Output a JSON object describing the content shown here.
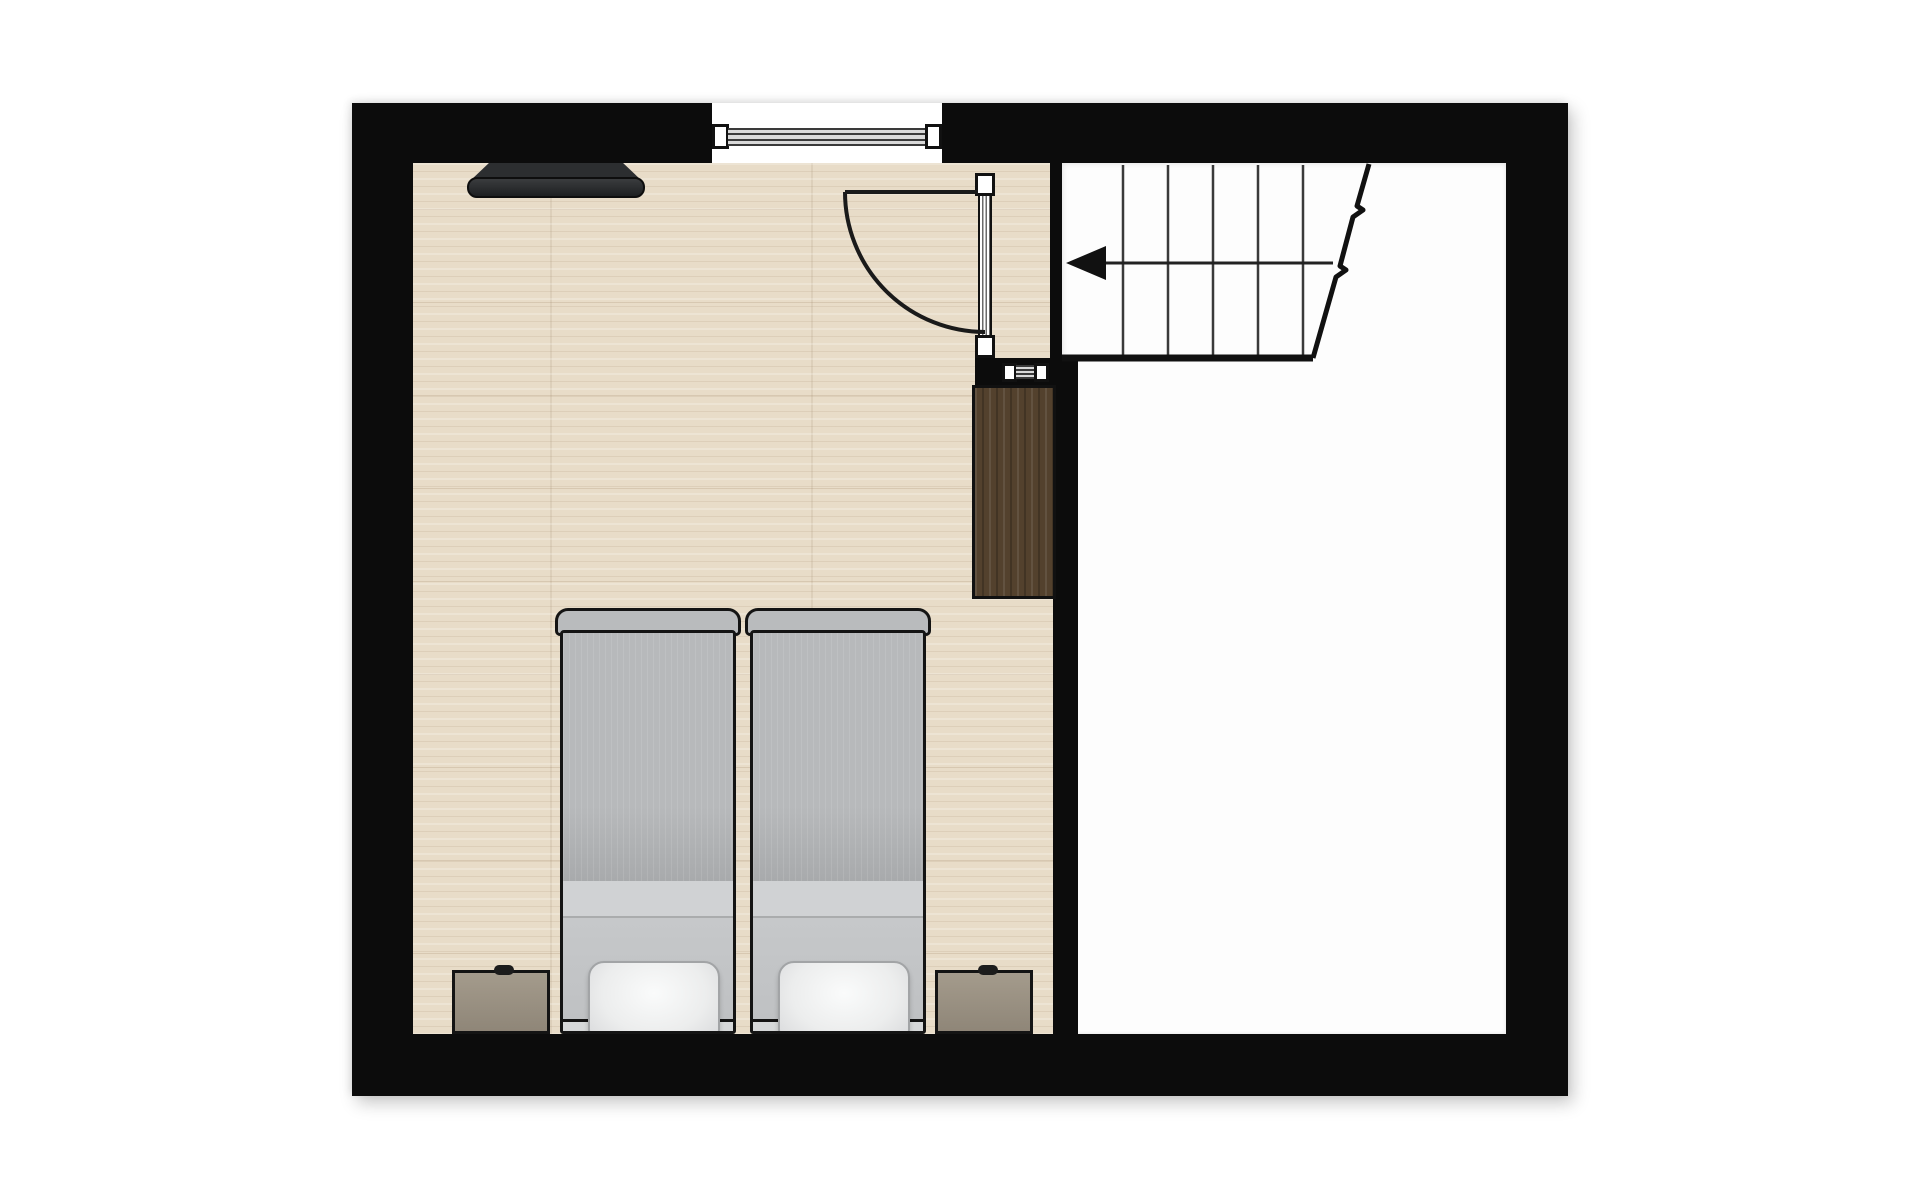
{
  "scene": {
    "type": "floor-plan",
    "description": "Upper-floor bedroom plan with two twin beds, two nightstands, wardrobe, wall TV, window, swing door and staircase landing next to an empty stair-hall room"
  },
  "palette": {
    "wall": "#0c0c0c",
    "wood_floor": "#e8dcc8",
    "wood_grain": "#927555",
    "white_room": "#fdfdfd",
    "wardrobe_wood": "#53412d",
    "nightstand": "#9a9183",
    "bed_outline": "#141414",
    "duvet": "#b3b6b8",
    "fold_band": "#d0d2d4",
    "sheet": "#c3c5c7",
    "pillow": "#f2f3f4",
    "headboard": "#d6d8d9",
    "tv": "#2c2e30",
    "glazing_dark": "#3a3a3a",
    "glazing_light": "#d9d9d9"
  },
  "rooms": [
    {
      "name": "bedroom",
      "floor": "wood"
    },
    {
      "name": "stair-hall",
      "floor": "white"
    }
  ],
  "window": {
    "glazing_lines": 4,
    "position": "top-wall"
  },
  "mini_window": {
    "glazing_lines": 3,
    "position": "interior-stub-wall"
  },
  "door": {
    "hinge": "top",
    "swing": "into-bedroom",
    "arc": {
      "open_line": {
        "x1": 493,
        "y1": 89,
        "x2": 626,
        "y2": 89
      },
      "arc_path": "M493,89 A140,140 0 0 0 633,229"
    }
  },
  "stairs": {
    "tread_count": 5,
    "tread_xs": [
      771,
      816,
      861,
      906,
      951
    ],
    "tread_top_y": 62,
    "tread_bottom_y": 255,
    "bottom_line": {
      "x1": 710,
      "y1": 255,
      "x2": 961,
      "y2": 255
    },
    "break_line_path": "M1017,61 L1005,103 l6,4 l-10,7 L988,163 l6,4 l-10,7 L961,255",
    "arrow": {
      "direction": "left",
      "line": {
        "x1": 754,
        "y1": 160,
        "x2": 981,
        "y2": 160
      },
      "head_points": "714,160 754,143 754,177"
    }
  },
  "beds": [
    {
      "id": "twin-bed-left",
      "x": 203
    },
    {
      "id": "twin-bed-right",
      "x": 393
    }
  ],
  "nightstands": [
    {
      "id": "nightstand-left",
      "x": 100,
      "knob_left": 39
    },
    {
      "id": "nightstand-right",
      "x": 583,
      "knob_left": 40
    }
  ]
}
